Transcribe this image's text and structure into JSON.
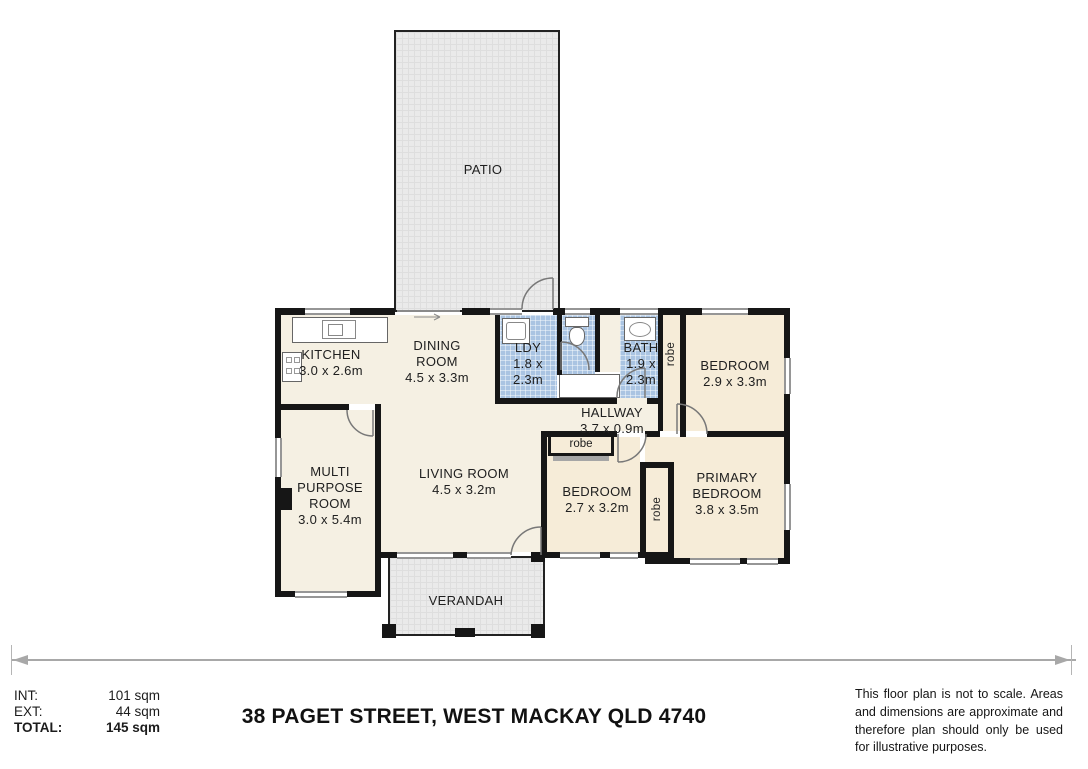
{
  "plan": {
    "patio_label": "PATIO",
    "verandah_label": "VERANDAH",
    "robe_label": "robe",
    "rooms": {
      "kitchen": {
        "name": "KITCHEN",
        "dims": "3.0 x 2.6m"
      },
      "dining": {
        "name": "DINING ROOM",
        "dims": "4.5 x 3.3m"
      },
      "laundry": {
        "name": "LDY",
        "dims": "1.8 x 2.3m"
      },
      "bath": {
        "name": "BATH",
        "dims": "1.9 x 2.3m"
      },
      "bedroom_top": {
        "name": "BEDROOM",
        "dims": "2.9 x 3.3m"
      },
      "hallway": {
        "name": "HALLWAY",
        "dims": "3.7 x 0.9m"
      },
      "multi_purpose": {
        "name": "MULTI PURPOSE ROOM",
        "dims": "3.0 x 5.4m"
      },
      "living": {
        "name": "LIVING ROOM",
        "dims": "4.5 x 3.2m"
      },
      "bedroom_left": {
        "name": "BEDROOM",
        "dims": "2.7 x 3.2m"
      },
      "primary_bedroom": {
        "name": "PRIMARY BEDROOM",
        "dims": "3.8 x 3.5m"
      }
    }
  },
  "footer": {
    "areas": [
      {
        "label": "INT:",
        "value": "101 sqm"
      },
      {
        "label": "EXT:",
        "value": "44 sqm"
      },
      {
        "label": "TOTAL:",
        "value": "145 sqm"
      }
    ],
    "address": "38 PAGET STREET, WEST MACKAY QLD 4740",
    "disclaimer": "This floor plan is not to scale. Areas and dimensions are approximate and therefore plan should only be used for illustrative purposes."
  },
  "colors": {
    "wet_area_blue": "#aac4e2",
    "floor_cream": "#f5f0e3",
    "floor_tan": "#f6ecd8",
    "outdoor_grid": "#eaeaea",
    "wall_black": "#161616"
  }
}
